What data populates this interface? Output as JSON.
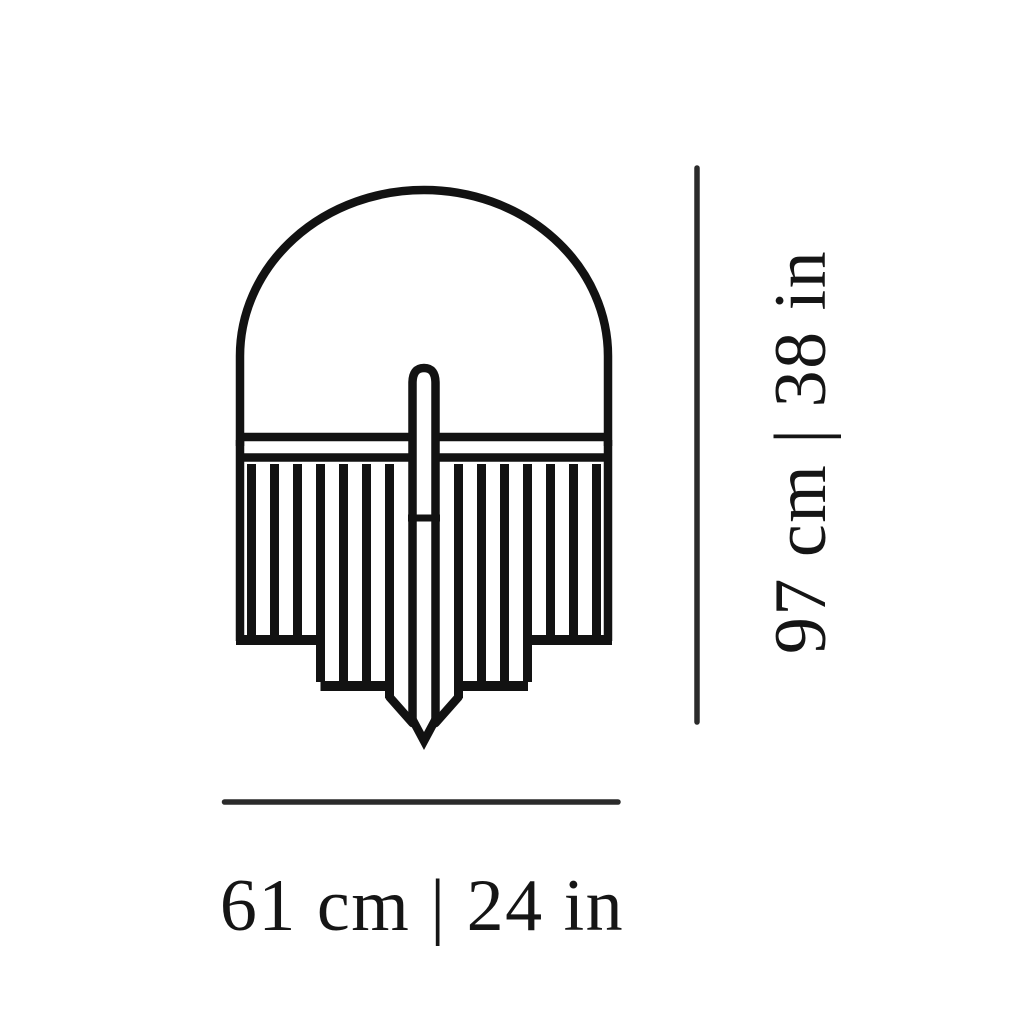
{
  "diagram": {
    "kind": "product-dimension-diagram",
    "drawing": "fringed-dome-lamp-front-view-line-drawing"
  },
  "dimensions": {
    "width_label": "61 cm | 24 in",
    "height_label": "97 cm | 38 in"
  },
  "colors": {
    "background": "#ffffff",
    "line_art": "#121212",
    "dimension_line": "#2b2b2b",
    "text": "#151515"
  }
}
